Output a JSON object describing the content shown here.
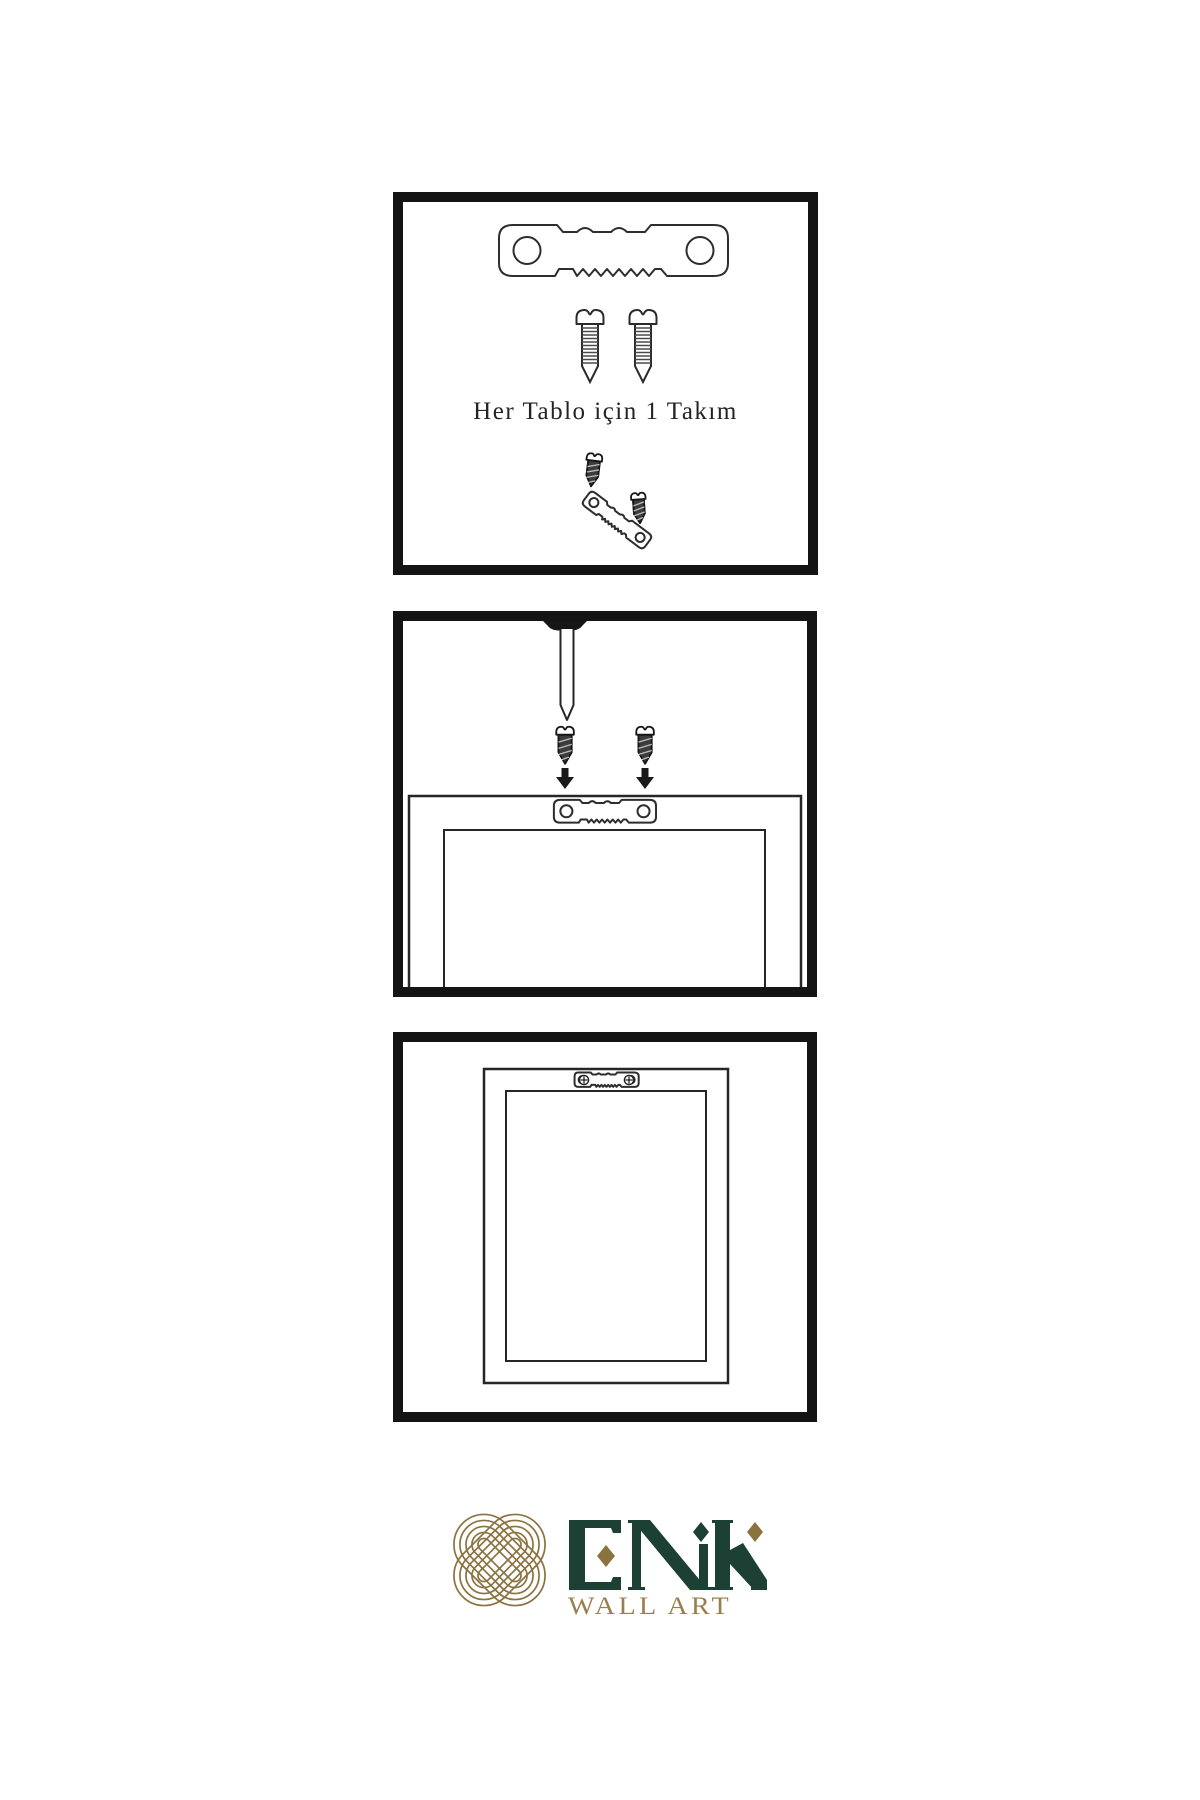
{
  "sheet": {
    "background": "#ffffff",
    "ink": "#262626",
    "panel_border": "#141414"
  },
  "kit_panel": {
    "label": "Her Tablo için 1 Takım"
  },
  "logo": {
    "brand": "ENK",
    "subtitle": "WALL ART",
    "colors": {
      "knot_gold": "#8b7340",
      "brand_green": "#1c4134",
      "subtitle_gold": "#97804d"
    }
  },
  "icons": {
    "sawtooth_hanger": "sawtooth-hanger-icon",
    "screw": "screw-icon",
    "dark_screw": "dark-screw-icon",
    "wall_nail": "wall-nail-icon",
    "down_arrow": "down-arrow-icon",
    "frame_back": "frame-back-outline",
    "knot_mark": "interlocking-knot-icon"
  }
}
